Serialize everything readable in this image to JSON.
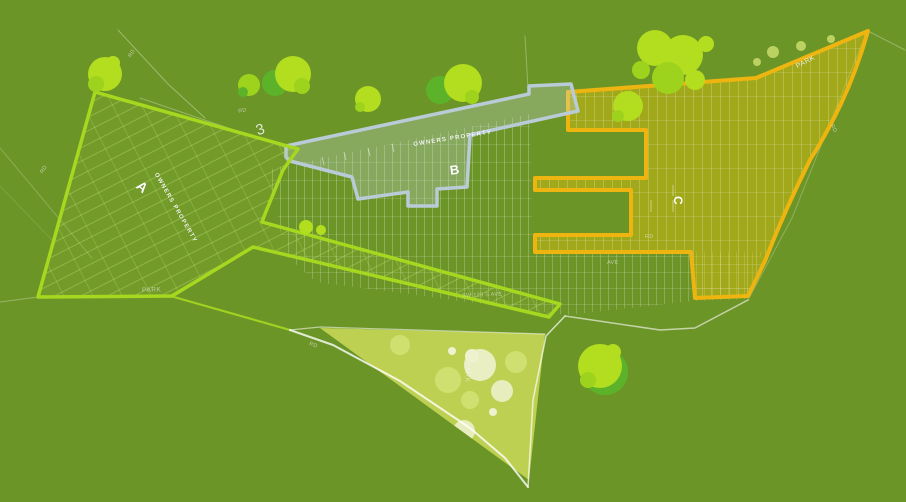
{
  "zones": {
    "a": {
      "label": "A",
      "annotation": "OWNERS PROPERTY"
    },
    "b": {
      "label": "B",
      "annotation": "OWNERS PROPERTY"
    },
    "c": {
      "label": "C"
    },
    "parcel": {
      "label": "3"
    }
  },
  "parks": {
    "northeast": "PARK",
    "south": "PARK",
    "west": "PARK"
  },
  "road_labels": [
    {
      "text": "RD"
    },
    {
      "text": "RD"
    },
    {
      "text": "RD"
    },
    {
      "text": "SW 123 S AVE"
    },
    {
      "text": "RD"
    },
    {
      "text": "AVE"
    },
    {
      "text": "RD"
    },
    {
      "text": "RD"
    }
  ],
  "colors": {
    "bg": "#6c9527",
    "zoneA": "#a6d820",
    "zoneB": "#b9cbd7",
    "zoneC": "#eeb511",
    "park": "#bdd052",
    "road": "#ffffff",
    "treeBright": "#b3dd1f",
    "treeMid": "#9ed31d",
    "treeDark": "#5cb32a",
    "parkTree": "#eef2cf",
    "parkBlob": "#cfe070"
  }
}
